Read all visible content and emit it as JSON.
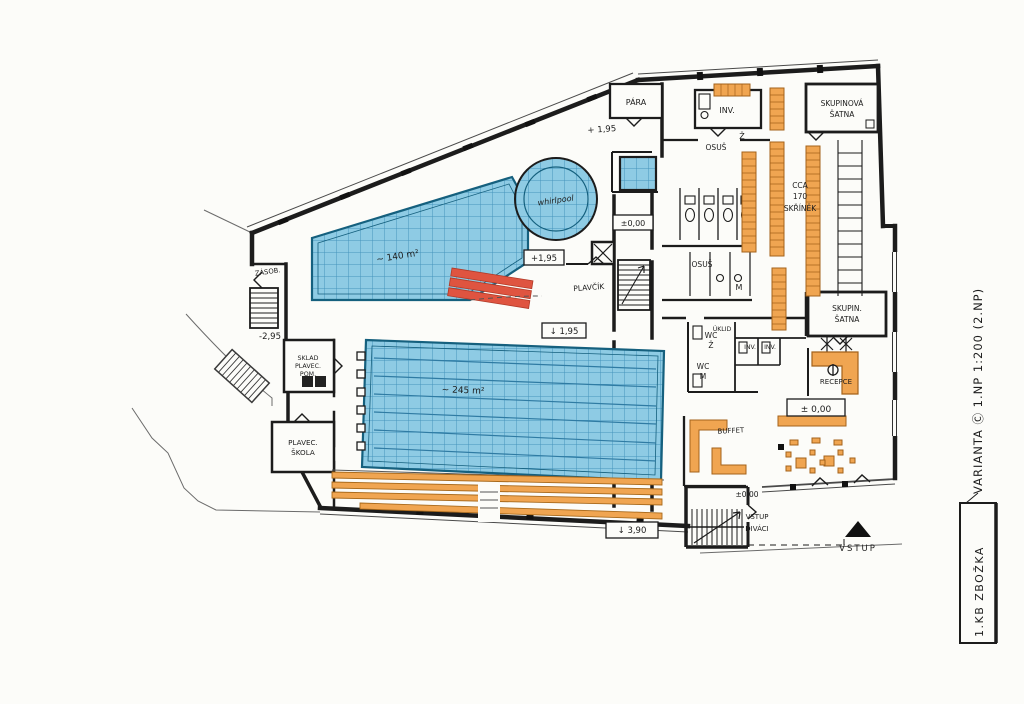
{
  "plan": {
    "pools": {
      "leisure_area": "~ 140 m²",
      "whirlpool": "whirlpool",
      "main_area": "~ 245 m²"
    },
    "rooms": {
      "para": "PÁRA",
      "inv_top": "INV.",
      "marker_z": "Ž",
      "marker_m": "M",
      "osus_a": "OSUŠ",
      "osus_b": "OSUŠ",
      "skupinova_satna_1": "SKUPINOVÁ",
      "skupinova_satna_2": "ŠATNA",
      "lockers_note_1": "CCA",
      "lockers_note_2": "170",
      "lockers_note_3": "SKŘÍNĚK",
      "zasob": "ZÁSOB.",
      "sklad_1": "SKLAD",
      "sklad_2": "PLAVEC.",
      "sklad_3": "POM.",
      "plavec_skola_1": "PLAVEC.",
      "plavec_skola_2": "ŠKOLA",
      "plavcik": "PLAVČÍK",
      "wc_z_1": "WC",
      "wc_z_2": "Ž",
      "uklid": "ÚKLID",
      "inv_a": "INV.",
      "inv_b": "INV.",
      "wc_m_1": "WC",
      "wc_m_2": "M",
      "skupin_satna_1": "SKUPIN.",
      "skupin_satna_2": "ŠATNA",
      "recepce": "RECEPCE",
      "buffet": "BUFFET"
    },
    "levels": {
      "plus195_deck": "+ 1,95",
      "plus195_box": "+1,95",
      "down195_box": "↓ 1,95",
      "zero_stair": "±0,00",
      "zero_recepce": "± 0,00",
      "zero_entry": "±0,00",
      "minus295": "-2,95",
      "down390_box": "↓ 3,90"
    },
    "entries": {
      "vstup": "VSTUP",
      "vstup_divaci_1": "VSTUP",
      "vstup_divaci_2": "DIVÁCI"
    },
    "margin": {
      "variant_note": "VARIANTA Ⓒ 1.NP 1:200 (2.NP)",
      "title_box": "1.KB ZBOŽKA"
    },
    "colors": {
      "pool_blue": "#8ecbe4",
      "pool_grid": "#4595bd",
      "wood_orange": "#f0a551",
      "slide_red": "#df5440",
      "ink": "#1c1c1c",
      "paper": "#fcfcf9"
    }
  }
}
